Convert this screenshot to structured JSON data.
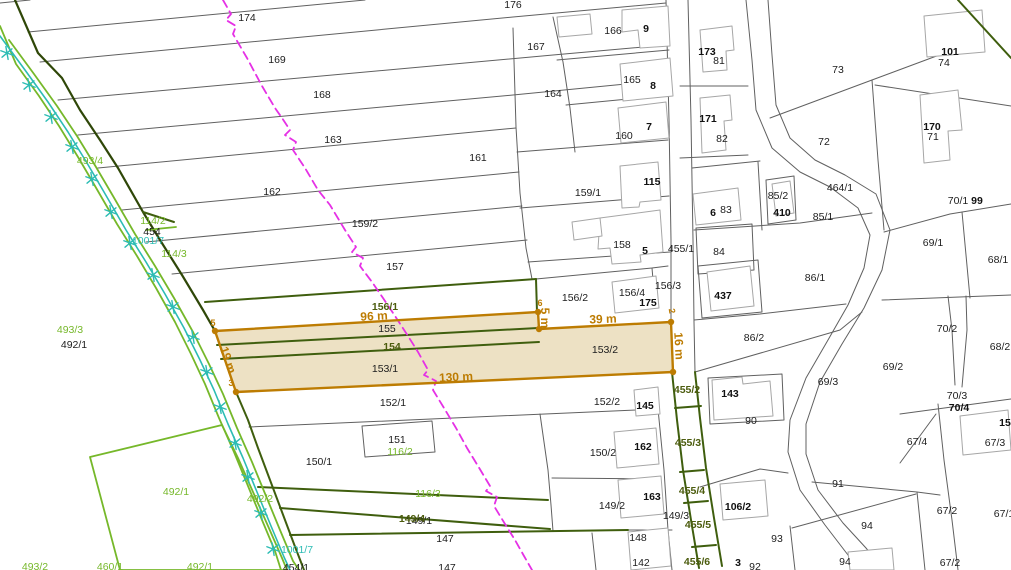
{
  "map": {
    "type": "cadastral-map",
    "width": 1011,
    "height": 570,
    "colors": {
      "background": "#ffffff",
      "parcel_line": "#606060",
      "building_line": "#a6a6a6",
      "olive_green": "#3f5e0e",
      "dark_boundary": "#2f4708",
      "bright_green": "#76b82a",
      "teal_utility": "#2cbcb4",
      "magenta_dashed": "#e531e5",
      "highlight_border": "#bd7c02",
      "highlight_fill": "#eadcba"
    },
    "highlight": {
      "parcels": [
        "155",
        "154",
        "153/1",
        "153/2"
      ],
      "measurements": [
        "96 m",
        "39 m",
        "130 m",
        "19 m",
        "16 m",
        "5 m"
      ]
    },
    "labels": [
      {
        "t": "176",
        "x": 513,
        "y": 5,
        "c": "p"
      },
      {
        "t": "174",
        "x": 247,
        "y": 18,
        "c": "p"
      },
      {
        "t": "169",
        "x": 277,
        "y": 60,
        "c": "p"
      },
      {
        "t": "168",
        "x": 322,
        "y": 95,
        "c": "p"
      },
      {
        "t": "163",
        "x": 333,
        "y": 140,
        "c": "p"
      },
      {
        "t": "162",
        "x": 272,
        "y": 192,
        "c": "p"
      },
      {
        "t": "167",
        "x": 536,
        "y": 47,
        "c": "p"
      },
      {
        "t": "166",
        "x": 613,
        "y": 31,
        "c": "p"
      },
      {
        "t": "9",
        "x": 646,
        "y": 29,
        "c": "b"
      },
      {
        "t": "165",
        "x": 632,
        "y": 80,
        "c": "p"
      },
      {
        "t": "8",
        "x": 653,
        "y": 86,
        "c": "b"
      },
      {
        "t": "164",
        "x": 553,
        "y": 94,
        "c": "p"
      },
      {
        "t": "160",
        "x": 624,
        "y": 136,
        "c": "p"
      },
      {
        "t": "7",
        "x": 649,
        "y": 127,
        "c": "b"
      },
      {
        "t": "161",
        "x": 478,
        "y": 158,
        "c": "p"
      },
      {
        "t": "115",
        "x": 652,
        "y": 182,
        "c": "b"
      },
      {
        "t": "159/1",
        "x": 588,
        "y": 193,
        "c": "p"
      },
      {
        "t": "159/2",
        "x": 365,
        "y": 224,
        "c": "p"
      },
      {
        "t": "157",
        "x": 395,
        "y": 267,
        "c": "p"
      },
      {
        "t": "158",
        "x": 622,
        "y": 245,
        "c": "p"
      },
      {
        "t": "5",
        "x": 645,
        "y": 251,
        "c": "b"
      },
      {
        "t": "455/1",
        "x": 681,
        "y": 249,
        "c": "p"
      },
      {
        "t": "6",
        "x": 713,
        "y": 213,
        "c": "b"
      },
      {
        "t": "83",
        "x": 726,
        "y": 210,
        "c": "p"
      },
      {
        "t": "84",
        "x": 719,
        "y": 252,
        "c": "p"
      },
      {
        "t": "173",
        "x": 707,
        "y": 52,
        "c": "b"
      },
      {
        "t": "81",
        "x": 719,
        "y": 61,
        "c": "p"
      },
      {
        "t": "171",
        "x": 708,
        "y": 119,
        "c": "b"
      },
      {
        "t": "82",
        "x": 722,
        "y": 139,
        "c": "p"
      },
      {
        "t": "73",
        "x": 838,
        "y": 70,
        "c": "p"
      },
      {
        "t": "72",
        "x": 824,
        "y": 142,
        "c": "p"
      },
      {
        "t": "101",
        "x": 950,
        "y": 52,
        "c": "b"
      },
      {
        "t": "74",
        "x": 944,
        "y": 63,
        "c": "p"
      },
      {
        "t": "170",
        "x": 932,
        "y": 127,
        "c": "b"
      },
      {
        "t": "71",
        "x": 933,
        "y": 137,
        "c": "p"
      },
      {
        "t": "85/2",
        "x": 778,
        "y": 196,
        "c": "p"
      },
      {
        "t": "410",
        "x": 782,
        "y": 213,
        "c": "b"
      },
      {
        "t": "464/1",
        "x": 840,
        "y": 188,
        "c": "p"
      },
      {
        "t": "85/1",
        "x": 823,
        "y": 217,
        "c": "p"
      },
      {
        "t": "70/1",
        "x": 958,
        "y": 201,
        "c": "p"
      },
      {
        "t": "99",
        "x": 977,
        "y": 201,
        "c": "b"
      },
      {
        "t": "69/1",
        "x": 933,
        "y": 243,
        "c": "p"
      },
      {
        "t": "68/1",
        "x": 998,
        "y": 260,
        "c": "p"
      },
      {
        "t": "86/1",
        "x": 815,
        "y": 278,
        "c": "p"
      },
      {
        "t": "437",
        "x": 723,
        "y": 296,
        "c": "b"
      },
      {
        "t": "156/2",
        "x": 575,
        "y": 298,
        "c": "p"
      },
      {
        "t": "156/4",
        "x": 632,
        "y": 293,
        "c": "p"
      },
      {
        "t": "175",
        "x": 648,
        "y": 303,
        "c": "b"
      },
      {
        "t": "156/3",
        "x": 668,
        "y": 286,
        "c": "p"
      },
      {
        "t": "86/2",
        "x": 754,
        "y": 338,
        "c": "p"
      },
      {
        "t": "70/2",
        "x": 947,
        "y": 329,
        "c": "p"
      },
      {
        "t": "68/2",
        "x": 1000,
        "y": 347,
        "c": "p"
      },
      {
        "t": "69/2",
        "x": 893,
        "y": 367,
        "c": "p"
      },
      {
        "t": "69/3",
        "x": 828,
        "y": 382,
        "c": "p"
      },
      {
        "t": "156/1",
        "x": 385,
        "y": 307,
        "c": "o"
      },
      {
        "t": "155",
        "x": 387,
        "y": 329,
        "c": "p"
      },
      {
        "t": "154",
        "x": 392,
        "y": 347,
        "c": "o"
      },
      {
        "t": "153/1",
        "x": 385,
        "y": 369,
        "c": "p"
      },
      {
        "t": "153/2",
        "x": 605,
        "y": 350,
        "c": "p"
      },
      {
        "t": "152/1",
        "x": 393,
        "y": 403,
        "c": "p"
      },
      {
        "t": "152/2",
        "x": 607,
        "y": 402,
        "c": "p"
      },
      {
        "t": "145",
        "x": 645,
        "y": 406,
        "c": "b"
      },
      {
        "t": "143",
        "x": 730,
        "y": 394,
        "c": "b"
      },
      {
        "t": "90",
        "x": 751,
        "y": 421,
        "c": "p"
      },
      {
        "t": "151",
        "x": 397,
        "y": 440,
        "c": "p"
      },
      {
        "t": "116/2",
        "x": 400,
        "y": 452,
        "c": "g"
      },
      {
        "t": "150/1",
        "x": 319,
        "y": 462,
        "c": "p"
      },
      {
        "t": "150/2",
        "x": 603,
        "y": 453,
        "c": "p"
      },
      {
        "t": "162",
        "x": 643,
        "y": 447,
        "c": "b"
      },
      {
        "t": "455/2",
        "x": 687,
        "y": 390,
        "c": "o"
      },
      {
        "t": "455/3",
        "x": 688,
        "y": 443,
        "c": "o"
      },
      {
        "t": "455/4",
        "x": 692,
        "y": 491,
        "c": "o"
      },
      {
        "t": "455/5",
        "x": 698,
        "y": 525,
        "c": "o"
      },
      {
        "t": "455/6",
        "x": 697,
        "y": 562,
        "c": "o"
      },
      {
        "t": "149/2",
        "x": 612,
        "y": 506,
        "c": "p"
      },
      {
        "t": "163",
        "x": 652,
        "y": 497,
        "c": "b"
      },
      {
        "t": "149/3",
        "x": 676,
        "y": 516,
        "c": "p"
      },
      {
        "t": "106/2",
        "x": 738,
        "y": 507,
        "c": "b"
      },
      {
        "t": "148",
        "x": 638,
        "y": 538,
        "c": "p"
      },
      {
        "t": "147",
        "x": 445,
        "y": 539,
        "c": "p"
      },
      {
        "t": "149/1",
        "x": 419,
        "y": 521,
        "c": "p"
      },
      {
        "t": "149/4",
        "x": 412,
        "y": 519,
        "c": "o"
      },
      {
        "t": "116/3",
        "x": 428,
        "y": 494,
        "c": "g"
      },
      {
        "t": "91",
        "x": 838,
        "y": 484,
        "c": "p"
      },
      {
        "t": "94",
        "x": 867,
        "y": 526,
        "c": "p"
      },
      {
        "t": "94",
        "x": 845,
        "y": 562,
        "c": "p"
      },
      {
        "t": "93",
        "x": 777,
        "y": 539,
        "c": "p"
      },
      {
        "t": "92",
        "x": 755,
        "y": 567,
        "c": "p"
      },
      {
        "t": "3",
        "x": 738,
        "y": 563,
        "c": "b"
      },
      {
        "t": "142",
        "x": 641,
        "y": 563,
        "c": "p"
      },
      {
        "t": "67/4",
        "x": 917,
        "y": 442,
        "c": "p"
      },
      {
        "t": "67/3",
        "x": 995,
        "y": 443,
        "c": "p"
      },
      {
        "t": "15",
        "x": 1005,
        "y": 423,
        "c": "b"
      },
      {
        "t": "67/2",
        "x": 947,
        "y": 511,
        "c": "p"
      },
      {
        "t": "67/2",
        "x": 950,
        "y": 563,
        "c": "p"
      },
      {
        "t": "67/1",
        "x": 1004,
        "y": 514,
        "c": "p"
      },
      {
        "t": "70/3",
        "x": 957,
        "y": 396,
        "c": "p"
      },
      {
        "t": "70/4",
        "x": 959,
        "y": 408,
        "c": "b"
      },
      {
        "t": "493/4",
        "x": 90,
        "y": 161,
        "c": "g"
      },
      {
        "t": "114/2",
        "x": 153,
        "y": 221,
        "c": "g"
      },
      {
        "t": "454",
        "x": 152,
        "y": 232,
        "c": "p"
      },
      {
        "t": "1001/7",
        "x": 148,
        "y": 241,
        "c": "t"
      },
      {
        "t": "114/3",
        "x": 174,
        "y": 254,
        "c": "g"
      },
      {
        "t": "493/3",
        "x": 70,
        "y": 330,
        "c": "g"
      },
      {
        "t": "492/1",
        "x": 74,
        "y": 345,
        "c": "p"
      },
      {
        "t": "492/1",
        "x": 176,
        "y": 492,
        "c": "g"
      },
      {
        "t": "492/2",
        "x": 260,
        "y": 499,
        "c": "g"
      },
      {
        "t": "1001/7",
        "x": 297,
        "y": 550,
        "c": "t"
      },
      {
        "t": "493/2",
        "x": 35,
        "y": 567,
        "c": "g"
      },
      {
        "t": "460/1",
        "x": 110,
        "y": 567,
        "c": "g"
      },
      {
        "t": "492/1",
        "x": 200,
        "y": 567,
        "c": "g"
      },
      {
        "t": "454/1",
        "x": 296,
        "y": 568,
        "c": "p"
      },
      {
        "t": "147",
        "x": 447,
        "y": 568,
        "c": "p"
      },
      {
        "t": "96 m",
        "x": 374,
        "y": 316,
        "c": "m",
        "r": -3
      },
      {
        "t": "39 m",
        "x": 603,
        "y": 319,
        "c": "m",
        "r": -2
      },
      {
        "t": "130 m",
        "x": 456,
        "y": 377,
        "c": "m",
        "r": -3
      },
      {
        "t": "19 m",
        "x": 228,
        "y": 360,
        "c": "m",
        "r": 71
      },
      {
        "t": "16 m",
        "x": 679,
        "y": 346,
        "c": "m",
        "r": 87
      },
      {
        "t": "5 m",
        "x": 545,
        "y": 318,
        "c": "m",
        "r": 90
      },
      {
        "t": "5",
        "x": 213,
        "y": 323,
        "c": "v"
      },
      {
        "t": "6",
        "x": 540,
        "y": 303,
        "c": "v"
      },
      {
        "t": "3",
        "x": 231,
        "y": 383,
        "c": "v"
      },
      {
        "t": "2",
        "x": 672,
        "y": 311,
        "c": "v",
        "r": 80
      }
    ]
  }
}
